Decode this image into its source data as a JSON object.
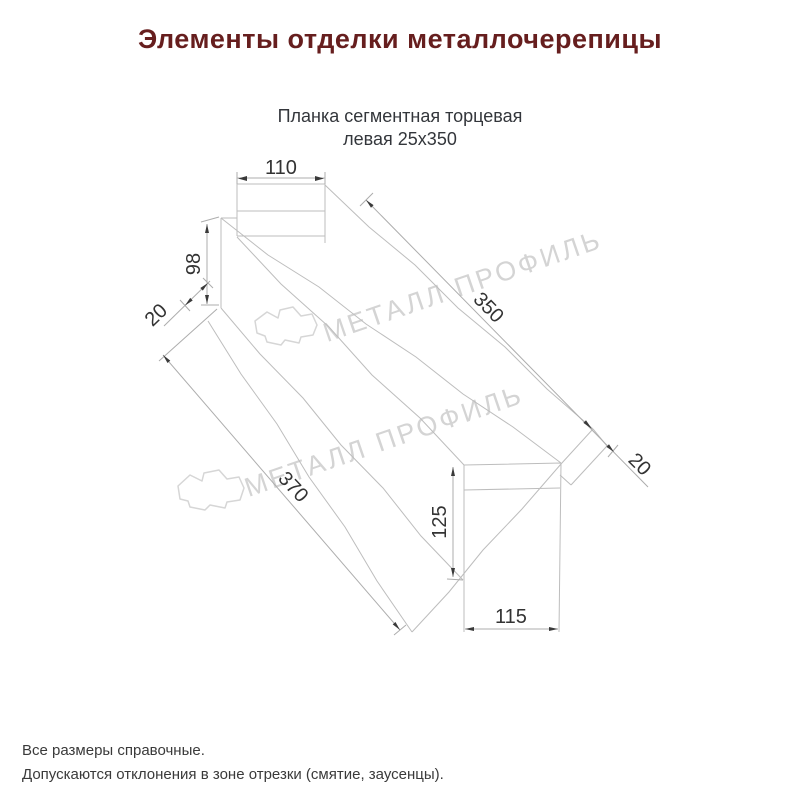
{
  "page": {
    "title": "Элементы отделки металлочерепицы",
    "subtitle_line1": "Планка сегментная торцевая",
    "subtitle_line2": "левая 25х350",
    "footnote_line1": "Все размеры справочные.",
    "footnote_line2": "Допускаются отклонения в зоне отрезки (смятие, заусенцы)."
  },
  "drawing": {
    "product_name": "Планка сегментная торцевая левая 25х350",
    "view": "isometric wireframe of segmented left end strip",
    "dims": {
      "top_width": "110",
      "left_height": "98",
      "left_flap": "20",
      "length_top": "350",
      "right_flap": "20",
      "length_bottom": "370",
      "cap_height": "125",
      "cap_width": "115"
    }
  },
  "watermark": {
    "text": "МЕТАЛЛ ПРОФИЛЬ",
    "logo": "cloud-logo"
  },
  "colors": {
    "title": "#661e1e",
    "body_text": "#3a3a3a",
    "drawing_lines": "#bdbdbd",
    "dimension_text": "#333333",
    "watermark": "#d4d4d4",
    "background": "#ffffff"
  }
}
